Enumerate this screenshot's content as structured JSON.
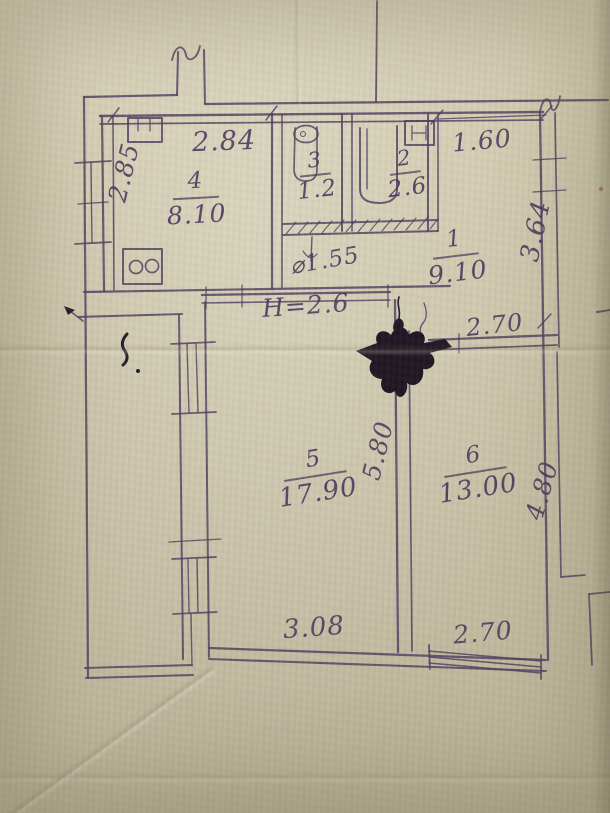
{
  "plan": {
    "ink_color": "#4c3a5e",
    "paper_color": "#c9c3a8",
    "height_note": "H=2.6",
    "rooms": [
      {
        "number": "1",
        "area": "9.10"
      },
      {
        "number": "2",
        "area": "2.6"
      },
      {
        "number": "3",
        "area": "1.2"
      },
      {
        "number": "4",
        "area": "8.10"
      },
      {
        "number": "5",
        "area": "17.90"
      },
      {
        "number": "6",
        "area": "13.00"
      }
    ],
    "dimensions": {
      "room4_width_top": "2.84",
      "room4_depth_left": "2.85",
      "hall_width_top": "1.60",
      "hall_depth_right": "3.64",
      "corridor_width": "⌀1.55",
      "room6_width_top": "2.70",
      "room5_depth_right": "5.80",
      "room6_depth_right": "4.80",
      "room5_width_bottom": "3.08",
      "room6_width_bottom": "2.70"
    }
  }
}
